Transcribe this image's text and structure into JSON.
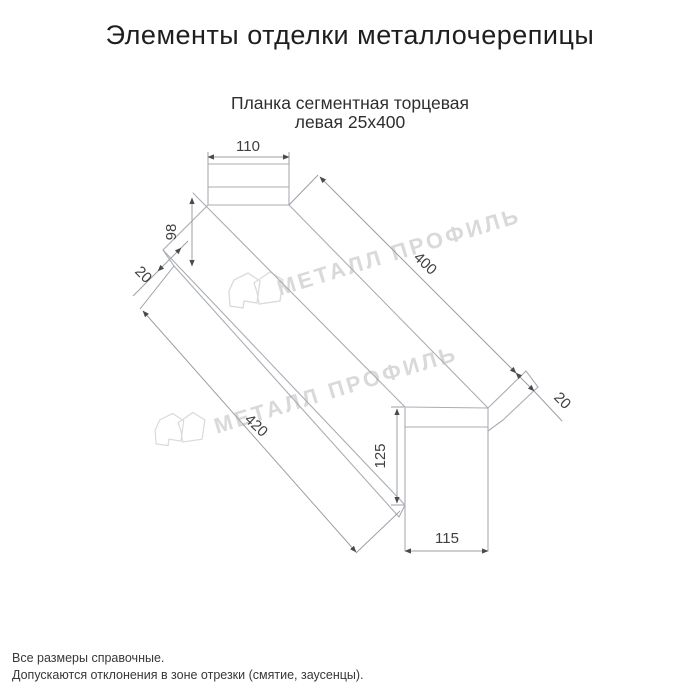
{
  "page": {
    "title": "Элементы отделки металлочерепицы"
  },
  "product": {
    "subtitle_line1": "Планка сегментная торцевая",
    "subtitle_line2": "левая 25х400"
  },
  "watermark": {
    "text": "МЕТАЛЛ ПРОФИЛЬ"
  },
  "drawing": {
    "dims": {
      "top_width": "110",
      "left_height": "98",
      "left_flange": "20",
      "length_top": "400",
      "right_flange": "20",
      "length_bottom": "420",
      "end_height": "125",
      "end_width": "115"
    }
  },
  "notes": [
    "Все размеры справочные.",
    "Допускаются отклонения в зоне отрезки (смятие, заусенцы)."
  ],
  "colors": {
    "profile_line": "#a9aeb4",
    "dimension_line": "#9aa0a6",
    "arrow": "#4a4a4a",
    "dimension_text": "#3f3f3f",
    "watermark": "#d9d9d9"
  }
}
